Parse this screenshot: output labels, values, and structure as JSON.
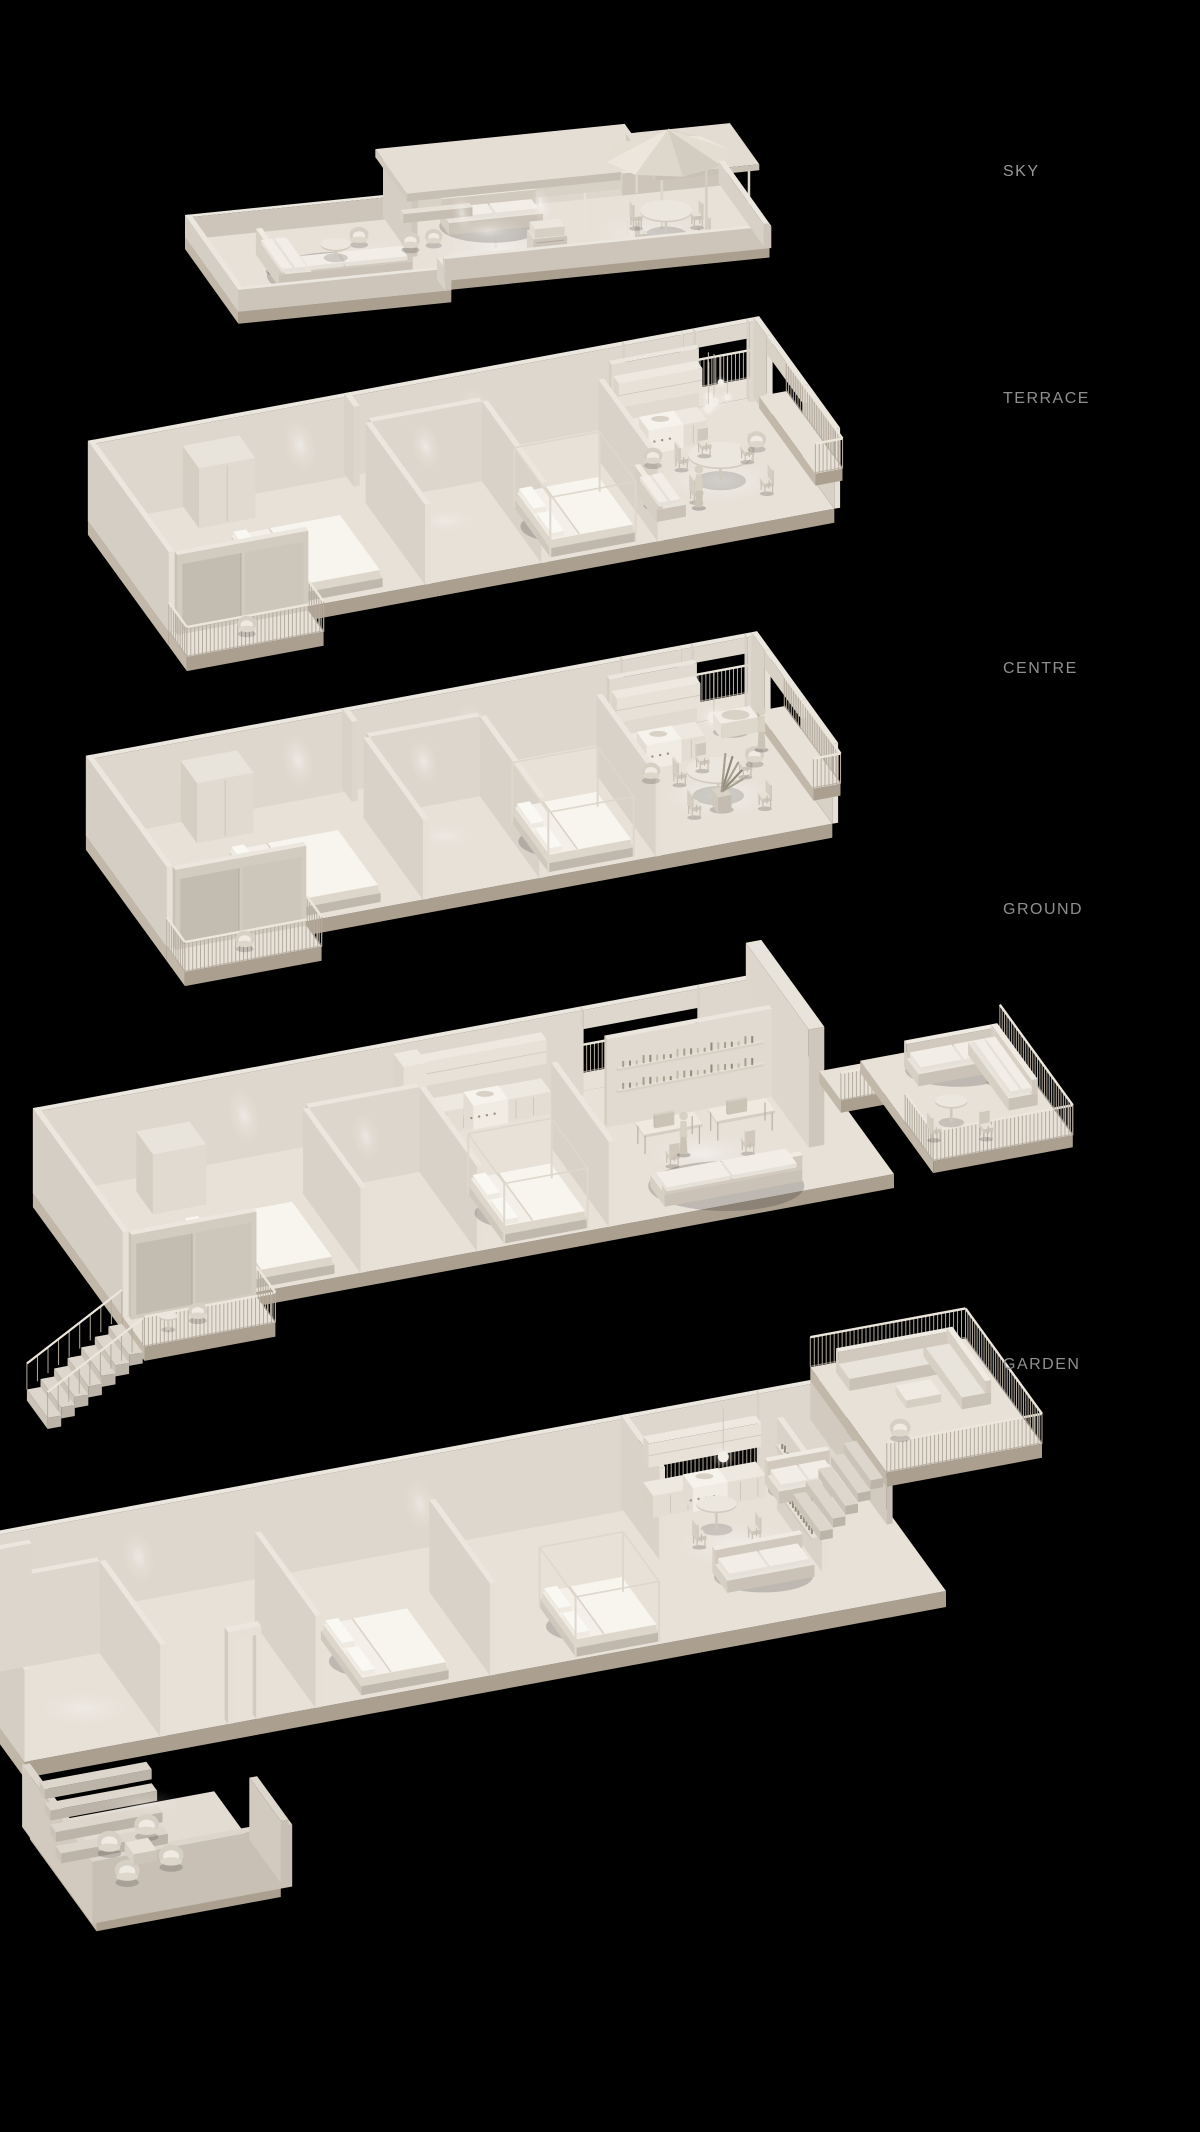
{
  "page": {
    "background": "#000000",
    "kind": "stacked-floor-cutaway-visualization"
  },
  "floors": [
    {
      "id": "sky",
      "label": "SKY",
      "items": [
        "roof-terrace",
        "penthouse-volume",
        "pergola",
        "parasol",
        "outdoor-dining-set",
        "outdoor-lounge-sofa",
        "bbq-grill",
        "parapet-walls",
        "downlights"
      ]
    },
    {
      "id": "terrace",
      "label": "TERRACE",
      "items": [
        "front-balcony-railing",
        "bedroom",
        "bedroom-with-frame",
        "bathroom-pods",
        "kitchen-run",
        "round-dining-table",
        "pendant-light-cluster",
        "armchairs",
        "person-figure",
        "rear-balcony"
      ]
    },
    {
      "id": "centre",
      "label": "CENTRE",
      "items": [
        "front-balcony-railing",
        "bedroom",
        "bedroom-with-frame",
        "bathroom-pods",
        "kitchen-run",
        "round-dining-table",
        "pendant-light",
        "potted-plant",
        "bathtub",
        "rear-balcony"
      ]
    },
    {
      "id": "ground",
      "label": "GROUND",
      "items": [
        "entry-staircase",
        "front-balcony",
        "bedroom",
        "bedroom-with-frame",
        "kitchen-run",
        "study-shelves",
        "desks",
        "sofa",
        "walkway-bridge",
        "lounge-balcony-corner-sofa"
      ]
    },
    {
      "id": "garden",
      "label": "GARDEN",
      "items": [
        "sunken-patio-lounge",
        "patio-steps",
        "bedroom",
        "bedroom-with-frame",
        "kitchen-run",
        "dining-table",
        "bookshelf-wall",
        "snug-sofa",
        "raised-terrace-corner-sofa",
        "terrace-stairs"
      ]
    }
  ],
  "palette": {
    "background": "#000000",
    "label": "#8f8f8f",
    "model_top": "#ebe6de",
    "model_side": "#d8d1c7",
    "model_front": "#c6beb2",
    "slab_edge": "#b4aa9b",
    "railing": "#b9b1a4",
    "linen": "#f4f0e9",
    "glow": "#ffffff"
  }
}
